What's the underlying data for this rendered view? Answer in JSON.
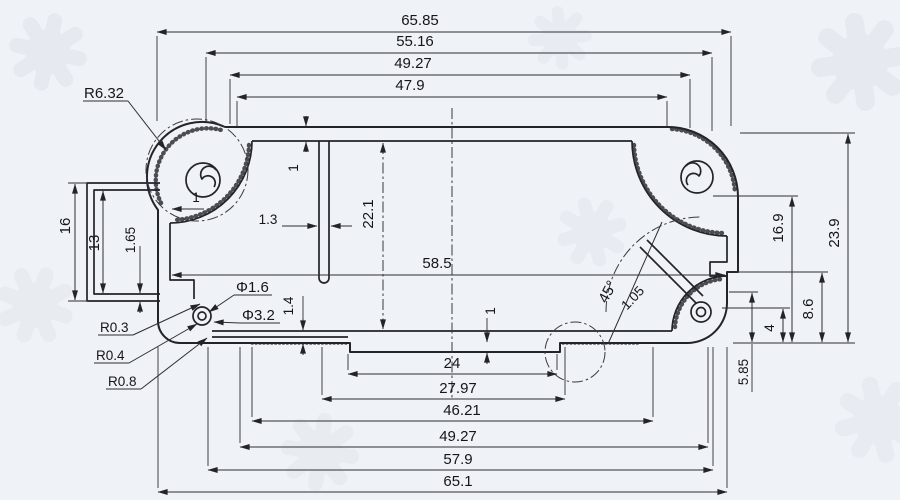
{
  "dims": {
    "top": [
      "65.85",
      "55.16",
      "49.27",
      "47.9"
    ],
    "bottom": [
      "24",
      "27.97",
      "46.21",
      "49.27",
      "57.9",
      "65.1"
    ],
    "left": {
      "outer": "16",
      "inner": "13",
      "wall": "1.65",
      "rib": "1.3",
      "side_wall": "1"
    },
    "interior": {
      "height": "22.1",
      "width": "58.5",
      "top_wall": "1",
      "foot": "1",
      "floor": "1.4"
    },
    "right": {
      "upper": "16.9",
      "overall": "23.9",
      "lower": "8.6",
      "notch": "4",
      "step": "5.85"
    }
  },
  "labels": {
    "radii": {
      "boss": "R6.32",
      "fillet_a": "R0.3",
      "fillet_b": "R0.4",
      "fillet_c": "R0.8"
    },
    "diameters": {
      "hole": "Φ1.6",
      "counterbore": "Φ3.2"
    },
    "angle": {
      "value": "45°",
      "slot_width": "1.05"
    }
  }
}
